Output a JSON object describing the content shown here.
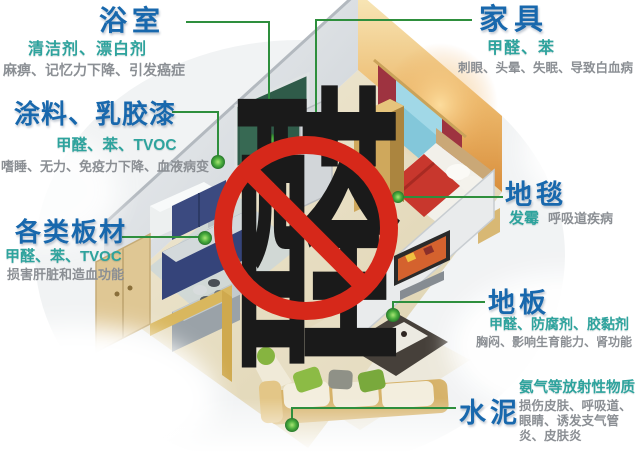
{
  "figure": {
    "subject": "indoor-decoration-pollution-infographic",
    "center_sign": {
      "character": "醛",
      "style": "red-prohibition-circle-with-slash-over-black-character"
    },
    "callouts": [
      {
        "id": "bathroom",
        "title": "浴室",
        "pollutants": "清洁剂、漂白剂",
        "effects": "麻痹、记忆力下降、引发癌症"
      },
      {
        "id": "furniture",
        "title": "家具",
        "pollutants": "甲醛、苯",
        "effects": "刺眼、头晕、失眠、导致白血病"
      },
      {
        "id": "paint-latex",
        "title": "涂料、乳胶漆",
        "pollutants": "甲醛、苯、TVOC",
        "effects": "嗜睡、无力、免疫力下降、血液病变"
      },
      {
        "id": "boards",
        "title": "各类板材",
        "pollutants": "甲醛、苯、TVOC",
        "effects": "损害肝脏和造血功能"
      },
      {
        "id": "carpet",
        "title": "地毯",
        "pollutants": "发霉",
        "effects": "呼吸道疾病"
      },
      {
        "id": "floor",
        "title": "地板",
        "pollutants": "甲醛、防腐剂、胶黏剂",
        "effects": "胸闷、影响生育能力、肾功能"
      },
      {
        "id": "cement",
        "title": "水泥",
        "pollutants": "氨气等放射性物质",
        "effects": "损伤皮肤、呼吸道、眼睛、诱发支气管炎、皮肤炎"
      }
    ],
    "colors": {
      "title": "#1868ad",
      "pollutant": "#2ea39d",
      "effect": "#8b8f94",
      "line": "#2e8f3d",
      "dot": "#45b649",
      "sign": "#d6281a",
      "glyph": "#1a1a1a"
    }
  }
}
